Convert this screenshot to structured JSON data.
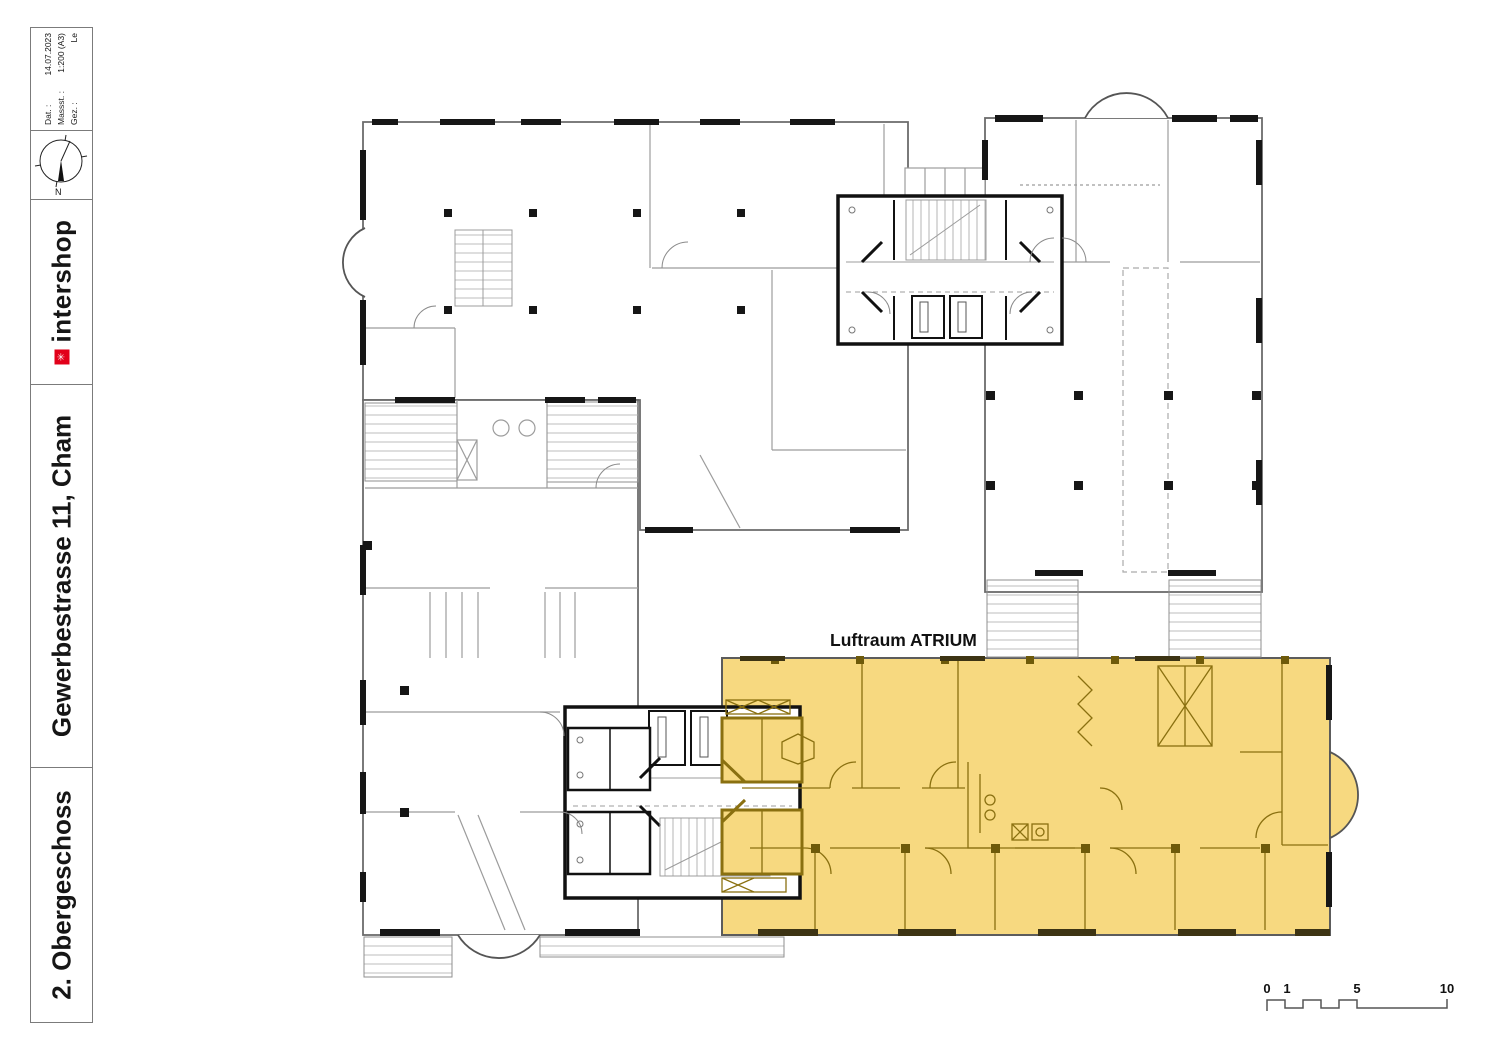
{
  "sheet": {
    "info": {
      "date_label": "Dat. :",
      "date_value": "14.07.2023",
      "scale_label": "Massst. :",
      "scale_value": "1:200 (A3)",
      "drawn_label": "Gez. :",
      "drawn_value": "Le"
    },
    "compass": {
      "north_label": "N"
    },
    "logo": {
      "text": "intershop",
      "mark": "✳",
      "mark_color": "#e2001a"
    },
    "project_title": "Gewerbestrasse 11, Cham",
    "sheet_title": "2. Obergeschoss"
  },
  "plan": {
    "atrium_label": "Luftraum ATRIUM",
    "highlight_color": "#f7d980",
    "highlight_line_color": "#8a7010"
  },
  "scale_bar": {
    "labels": [
      "0",
      "1",
      "5",
      "10"
    ]
  }
}
